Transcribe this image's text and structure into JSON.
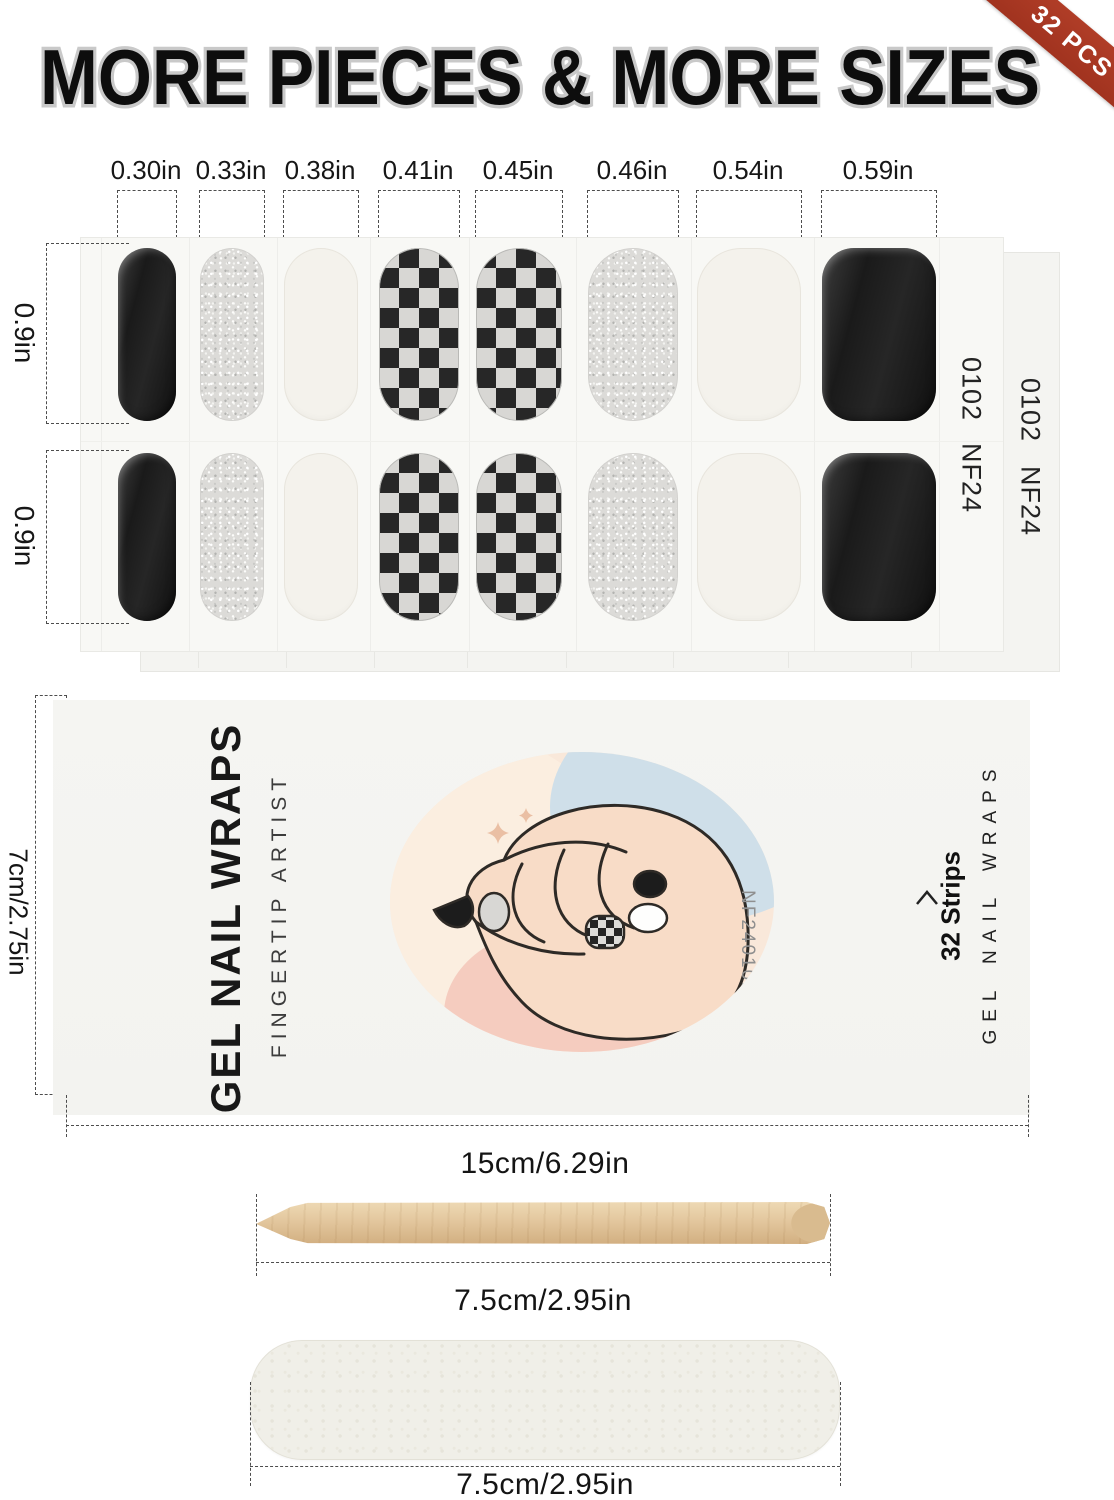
{
  "headline": {
    "text": "MORE PIECES & MORE SIZES"
  },
  "badge": {
    "label": "32 PCS",
    "color": "#a63a24"
  },
  "sheet": {
    "row_height_labels": [
      "0.9in",
      "0.9in"
    ],
    "front_code": {
      "top": "0102",
      "bottom": "NF24"
    },
    "back_code": {
      "top": "0102",
      "bottom": "NF24"
    },
    "columns": [
      {
        "label": "0.30in",
        "pattern": "black"
      },
      {
        "label": "0.33in",
        "pattern": "glitter"
      },
      {
        "label": "0.38in",
        "pattern": "cream"
      },
      {
        "label": "0.41in",
        "pattern": "checker"
      },
      {
        "label": "0.45in",
        "pattern": "checker"
      },
      {
        "label": "0.46in",
        "pattern": "glitter"
      },
      {
        "label": "0.54in",
        "pattern": "cream"
      },
      {
        "label": "0.59in",
        "pattern": "black"
      }
    ]
  },
  "package": {
    "brand": "GEL NAIL WRAPS",
    "tagline": "FINGERTIP ARTIST",
    "design_code": "NF240102",
    "strips_count": "32 Strips",
    "side_brand": "GEL NAIL WRAPS",
    "width_label": "15cm/6.29in",
    "height_label": "7cm/2.75in"
  },
  "tools": {
    "stick_length_label": "7.5cm/2.95in",
    "file_length_label": "7.5cm/2.95in"
  },
  "colors": {
    "accent_red": "#a63a24",
    "strip_black": "#1f1f1f",
    "glitter_silver": "#dbdad7",
    "cream": "#f4f1ea",
    "wood": "#dfc29b"
  }
}
